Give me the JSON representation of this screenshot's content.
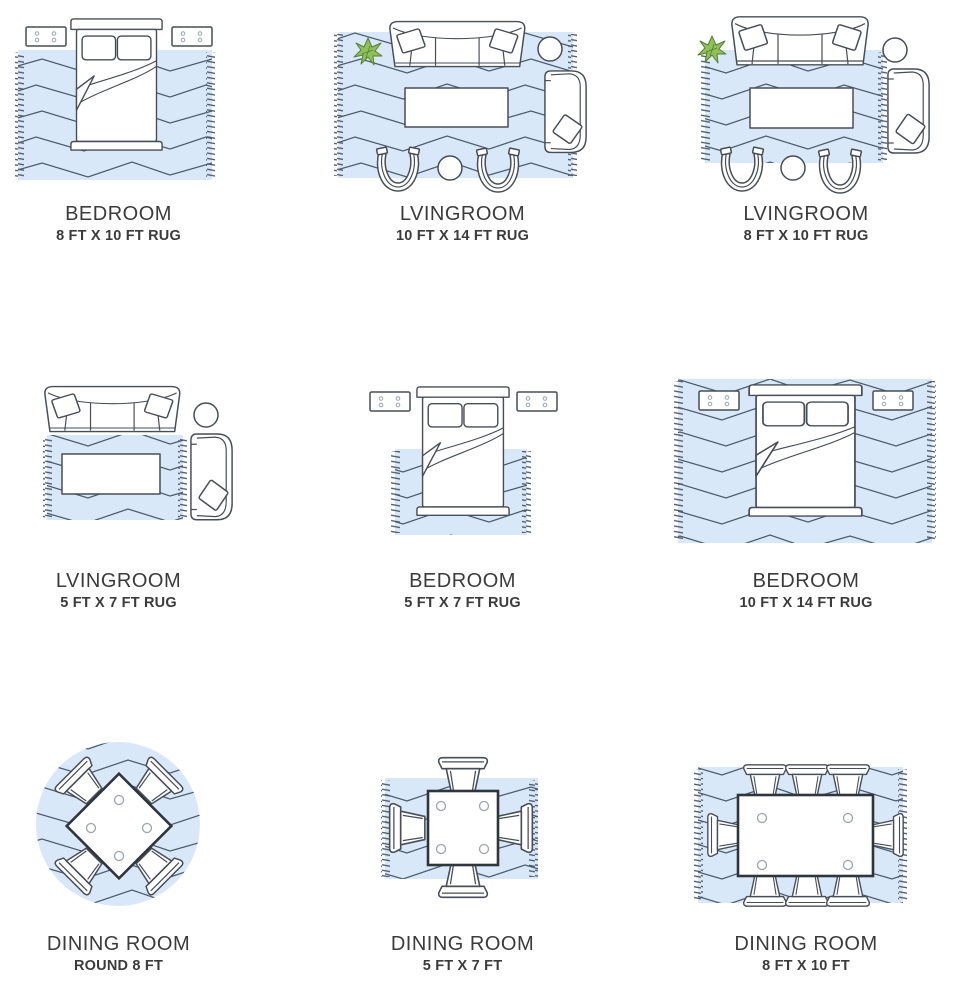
{
  "page": {
    "background": "#ffffff",
    "description": "Rug size guide infographic, 3x3 grid of room layouts"
  },
  "theme": {
    "colors": {
      "rug": "#d9e8f8",
      "pattern": "#4a5b6e",
      "ink": "#474e57",
      "ink2": "#2f353c",
      "soft": "#9aa5b0",
      "green": "#8fc05a",
      "greenDark": "#567f35",
      "text": "#3b3b3b"
    }
  },
  "cells": [
    {
      "room": "BEDROOM",
      "size": "8 FT X 10 FT RUG",
      "rug_shape": "rectangle",
      "icons": [
        "nightstand",
        "nightstand",
        "bed",
        "rug"
      ]
    },
    {
      "room": "LVINGROOM",
      "size": "10 FT X 14 FT RUG",
      "rug_shape": "rectangle",
      "icons": [
        "plant",
        "sofa",
        "side-table",
        "armchair",
        "coffee-table",
        "barrel-chair",
        "barrel-chair",
        "round-table",
        "rug"
      ]
    },
    {
      "room": "LVINGROOM",
      "size": "8 FT X 10 FT RUG",
      "rug_shape": "rectangle",
      "icons": [
        "plant",
        "sofa",
        "side-table",
        "armchair",
        "coffee-table",
        "barrel-chair",
        "barrel-chair",
        "round-table",
        "rug"
      ]
    },
    {
      "room": "LVINGROOM",
      "size": "5 FT X 7 FT RUG",
      "rug_shape": "rectangle",
      "icons": [
        "sofa",
        "side-table",
        "coffee-table",
        "armchair",
        "rug"
      ]
    },
    {
      "room": "BEDROOM",
      "size": "5 FT X 7 FT RUG",
      "rug_shape": "rectangle",
      "icons": [
        "nightstand",
        "nightstand",
        "bed",
        "rug"
      ]
    },
    {
      "room": "BEDROOM",
      "size": "10 FT X 14 FT RUG",
      "rug_shape": "rectangle",
      "icons": [
        "nightstand",
        "nightstand",
        "bed",
        "rug"
      ]
    },
    {
      "room": "DINING ROOM",
      "size": "ROUND 8 FT",
      "rug_shape": "round",
      "icons": [
        "dining-table",
        "dining-chair",
        "dining-chair",
        "dining-chair",
        "dining-chair",
        "rug"
      ]
    },
    {
      "room": "DINING ROOM",
      "size": "5 FT X 7 FT",
      "rug_shape": "rectangle",
      "icons": [
        "dining-table",
        "dining-chair",
        "dining-chair",
        "dining-chair",
        "dining-chair",
        "rug"
      ]
    },
    {
      "room": "DINING ROOM",
      "size": "8 FT X 10 FT",
      "rug_shape": "rectangle",
      "icons": [
        "dining-table",
        "dining-chair",
        "dining-chair",
        "dining-chair",
        "dining-chair",
        "dining-chair",
        "dining-chair",
        "dining-chair",
        "dining-chair",
        "rug"
      ]
    }
  ]
}
